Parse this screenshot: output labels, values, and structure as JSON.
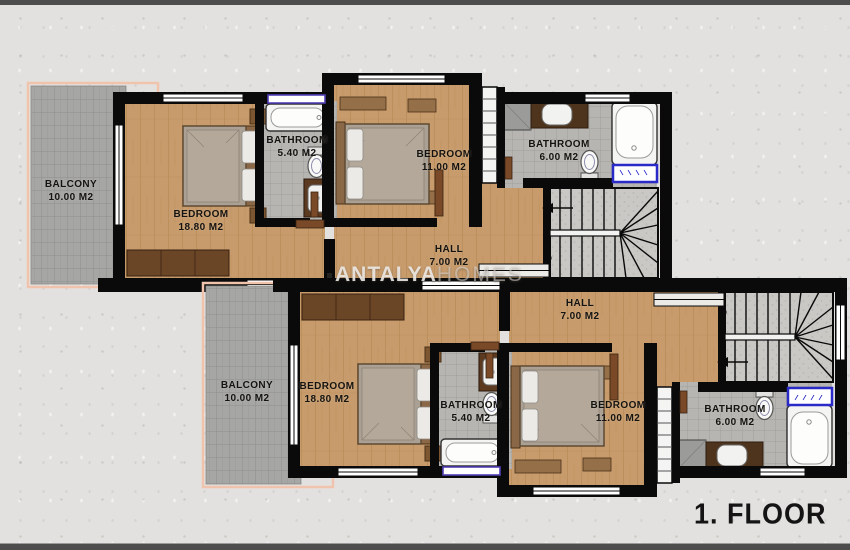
{
  "page": {
    "floor_label": "1. FLOOR"
  },
  "watermark": {
    "brand_bold": "ANTALYA",
    "brand_light": "HOMES"
  },
  "units": {
    "upper": {
      "rooms": [
        {
          "id": "balcony",
          "name": "BALCONY",
          "area": "10.00 M2"
        },
        {
          "id": "bedroom-large",
          "name": "BEDROOM",
          "area": "18.80 M2"
        },
        {
          "id": "bathroom-small",
          "name": "BATHROOM",
          "area": "5.40 M2"
        },
        {
          "id": "bedroom-small",
          "name": "BEDROOM",
          "area": "11.00 M2"
        },
        {
          "id": "bathroom-large",
          "name": "BATHROOM",
          "area": "6.00 M2"
        },
        {
          "id": "hall",
          "name": "HALL",
          "area": "7.00 M2"
        }
      ]
    },
    "lower": {
      "rooms": [
        {
          "id": "balcony",
          "name": "BALCONY",
          "area": "10.00 M2"
        },
        {
          "id": "bedroom-large",
          "name": "BEDROOM",
          "area": "18.80 M2"
        },
        {
          "id": "bathroom-small",
          "name": "BATHROOM",
          "area": "5.40 M2"
        },
        {
          "id": "bedroom-small",
          "name": "BEDROOM",
          "area": "11.00 M2"
        },
        {
          "id": "bathroom-large",
          "name": "BATHROOM",
          "area": "6.00 M2"
        },
        {
          "id": "hall",
          "name": "HALL",
          "area": "7.00 M2"
        }
      ]
    }
  },
  "colors": {
    "wall": "#0a0a0a",
    "wood_floor": "#c79b6b",
    "balcony_tile": "#a6a6a4",
    "bath_tile": "#b6b5b2",
    "balcony_border": "#f0c4ac",
    "window_blue": "#2a2ac8",
    "window_purple": "#5040b5",
    "background": "#e2e1df",
    "frame_bar": "#4d4d4d"
  }
}
